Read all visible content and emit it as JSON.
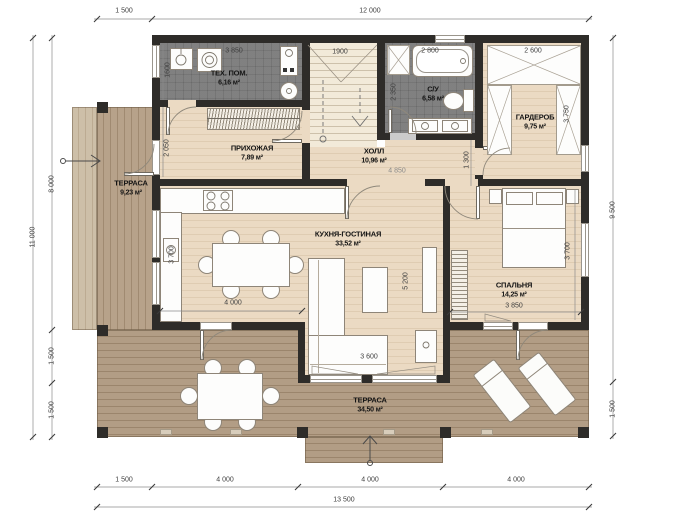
{
  "rooms": {
    "tech": {
      "name": "ТЕХ. ПОМ.",
      "area": "6,16 м²"
    },
    "hallway": {
      "name": "ПРИХОЖАЯ",
      "area": "7,89 м²"
    },
    "hall": {
      "name": "ХОЛЛ",
      "area": "10,96 м²"
    },
    "bathroom": {
      "name": "С/У",
      "area": "6,58 м²"
    },
    "wardrobe": {
      "name": "ГАРДЕРОБ",
      "area": "9,75 м²"
    },
    "terrace_left": {
      "name": "ТЕРРАСА",
      "area": "9,23 м²"
    },
    "kitchen_living": {
      "name": "КУХНЯ-ГОСТИНАЯ",
      "area": "33,52 м²"
    },
    "bedroom": {
      "name": "СПАЛЬНЯ",
      "area": "14,25 м²"
    },
    "terrace_main": {
      "name": "ТЕРРАСА",
      "area": "34,50 м²"
    }
  },
  "dimensions": {
    "top": {
      "d1": "1 500",
      "d2": "12 000"
    },
    "bottom": {
      "d1": "1 500",
      "d2": "4 000",
      "d3": "4 000",
      "d4": "4 000",
      "total": "13 500"
    },
    "left": {
      "d1": "8 000",
      "d2": "1 500",
      "d3": "1 500",
      "total": "11 000"
    },
    "right": {
      "d1": "9 500",
      "d2": "1 500"
    },
    "interior": {
      "tech_width": "3 850",
      "tech_depth": "1600",
      "hallway_door": "2 050",
      "stair_width": "1900",
      "bath_width": "2 800",
      "bath_depth": "2 350",
      "wardrobe_width": "2 600",
      "wardrobe_depth": "3 750",
      "hall_width": "4 850",
      "hall_passage": "1 300",
      "kitchen_depth": "3 700",
      "kitchen_width": "4 000",
      "living_depth": "5 200",
      "living_width": "3 600",
      "bedroom_width": "3 850",
      "bedroom_depth": "3 700"
    }
  },
  "colors": {
    "wall": "#2e2c29",
    "floor_wood": "#ebdac3",
    "floor_tile": "#cbcbcb",
    "deck": "#b29d85",
    "label_text": "#151515"
  }
}
